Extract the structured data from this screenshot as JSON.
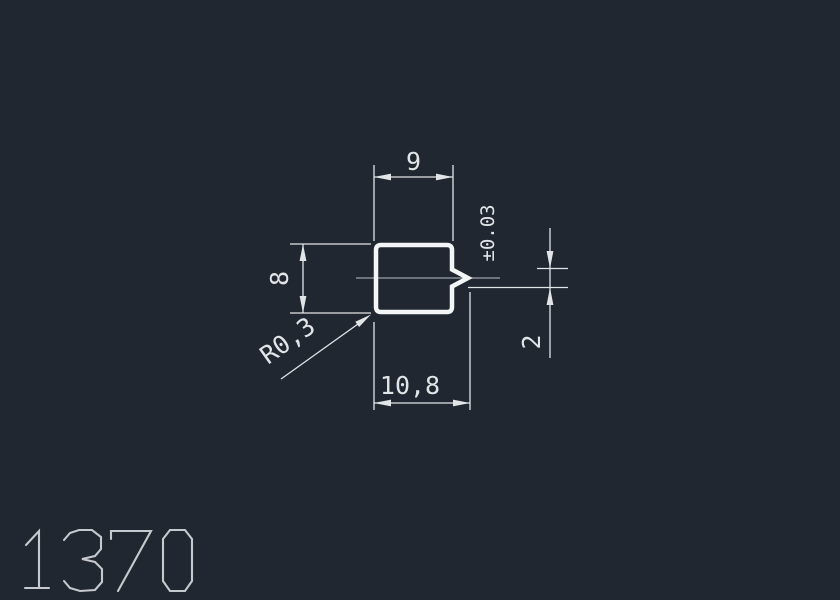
{
  "drawing": {
    "profile_number": "1370",
    "dimensions": {
      "top_width": "9",
      "height": "8",
      "corner_radius": "R0,3",
      "total_width": "10,8",
      "notch_height": "2",
      "tolerance": "±0.03"
    },
    "colors": {
      "background": "#212731",
      "profile_line": "#f4f5f6",
      "dimension_line": "#e2e5e8",
      "centerline": "#9aa1a8",
      "title": "#c6c9cd"
    }
  }
}
